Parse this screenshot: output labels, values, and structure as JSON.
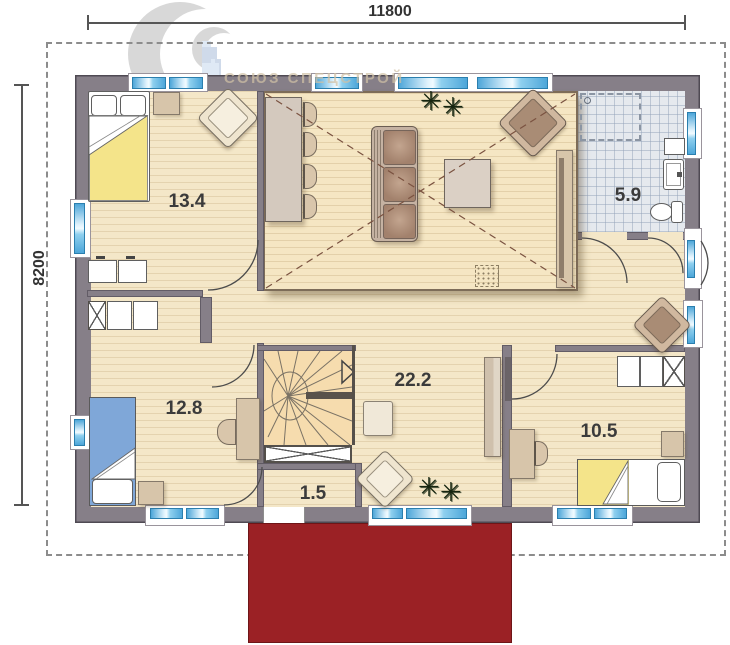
{
  "plan": {
    "watermark_text": "СОЮЗ СПЕЦСТРОЙ",
    "dim_top": "11800",
    "dim_left": "8200",
    "rooms": [
      {
        "key": "bedroom-upper-left",
        "area": "13.4"
      },
      {
        "key": "bathroom",
        "area": "5.9"
      },
      {
        "key": "living-hall",
        "area": "22.2"
      },
      {
        "key": "bedroom-lower-left",
        "area": "12.8"
      },
      {
        "key": "entry",
        "area": "1.5"
      },
      {
        "key": "bedroom-lower-right",
        "area": "10.5"
      }
    ],
    "icons": {
      "plant": "✳"
    },
    "colors": {
      "wall": "#867f88",
      "floor": "#f4e7c8",
      "bathroom_tile": "#e5e9ee",
      "window_glass": "#4da6d9",
      "porch": "#9b2125",
      "bed_yellow": "#f4e48a",
      "bed_blue": "#7fa7d8",
      "furniture_wood": "#d7c5aa",
      "watermark": "#d0c0a5"
    }
  }
}
